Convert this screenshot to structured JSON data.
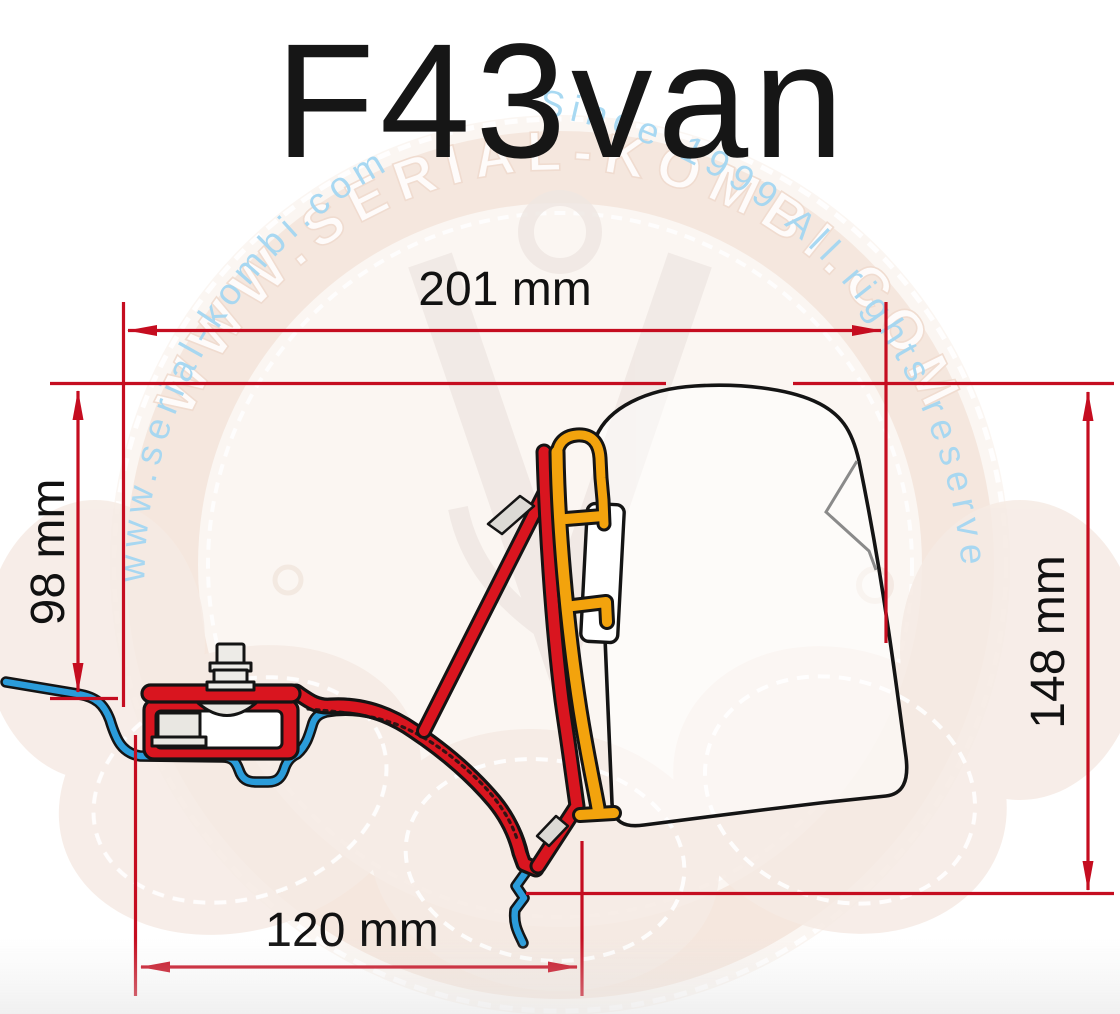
{
  "title": "F43van",
  "watermark": {
    "arc_url": "www.serial-kombi.com",
    "arc_since": "Since-1999 All rights reserved",
    "ring_text": "WWW.SERIAL-KOMBI.COM"
  },
  "dimensions": {
    "top_width": "201 mm",
    "left_height": "98 mm",
    "right_height": "148 mm",
    "bottom_width": "120 mm"
  },
  "colors": {
    "dimension_red": "#c50d20",
    "adapter_red": "#d9151f",
    "bracket_yellow": "#f3a30d",
    "roof_blue": "#2b9cda",
    "outline_black": "#141414",
    "watermark_blue": "#a4d7f2",
    "watermark_pink": "#f4e5dc"
  }
}
